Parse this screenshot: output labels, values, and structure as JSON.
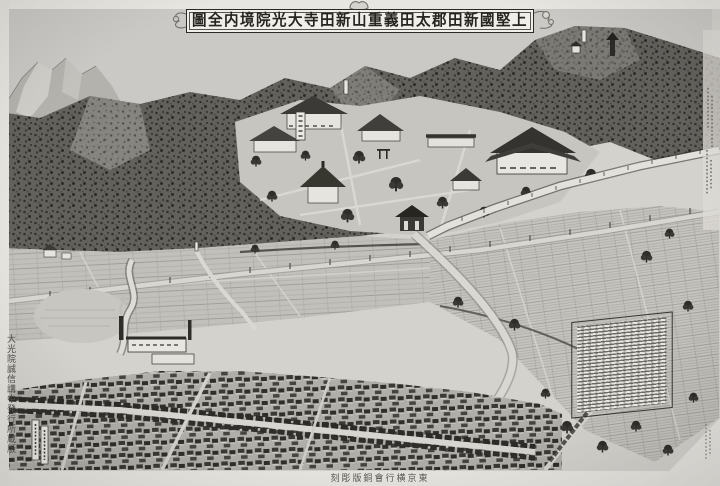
{
  "artifact": {
    "kind": "scanned copperplate bird's-eye-view map (Meiji-era Japan)",
    "subject": "Daikō-in temple precincts and Ōta town, Nitta district",
    "language": "ja",
    "monochrome": true
  },
  "title_banner": {
    "reading_rtl": "上堅國新田郡太田義重山新田寺大光院境内全圖",
    "display": "圖全内境院光大寺田新山重義田太郡田新國堅上"
  },
  "imprint_bottom": {
    "reading_rtl": "東京横行會銅版彫刻",
    "display": "刻彫版銅會行横京東"
  },
  "left_margin_note": {
    "text": "大光院誠信講中発行所蔵版",
    "orientation": "vertical",
    "legible": false
  },
  "inscription_panel": {
    "columns": 12,
    "legible": false,
    "description": "white panel of fine vertical text standing in the fields at lower right"
  },
  "small_labels": [
    {
      "name": "temple-signboard",
      "legible": false
    },
    {
      "name": "hilltop-label-left",
      "legible": false
    },
    {
      "name": "hilltop-label-right",
      "legible": false
    },
    {
      "name": "field-label-a",
      "legible": false
    },
    {
      "name": "field-label-b",
      "legible": false
    },
    {
      "name": "right-margin-note",
      "legible": false
    },
    {
      "name": "bottom-right-margin-note",
      "legible": false
    }
  ],
  "palette": {
    "paper": "#e9e7e2",
    "sky": "#cac9c5",
    "forest_dark": "#63615c",
    "forest_mid": "#8d8b85",
    "fields": "#c2c0ba",
    "town": "#b0aea8",
    "ink": "#2a2927",
    "white_walls": "#e8e6e1"
  }
}
